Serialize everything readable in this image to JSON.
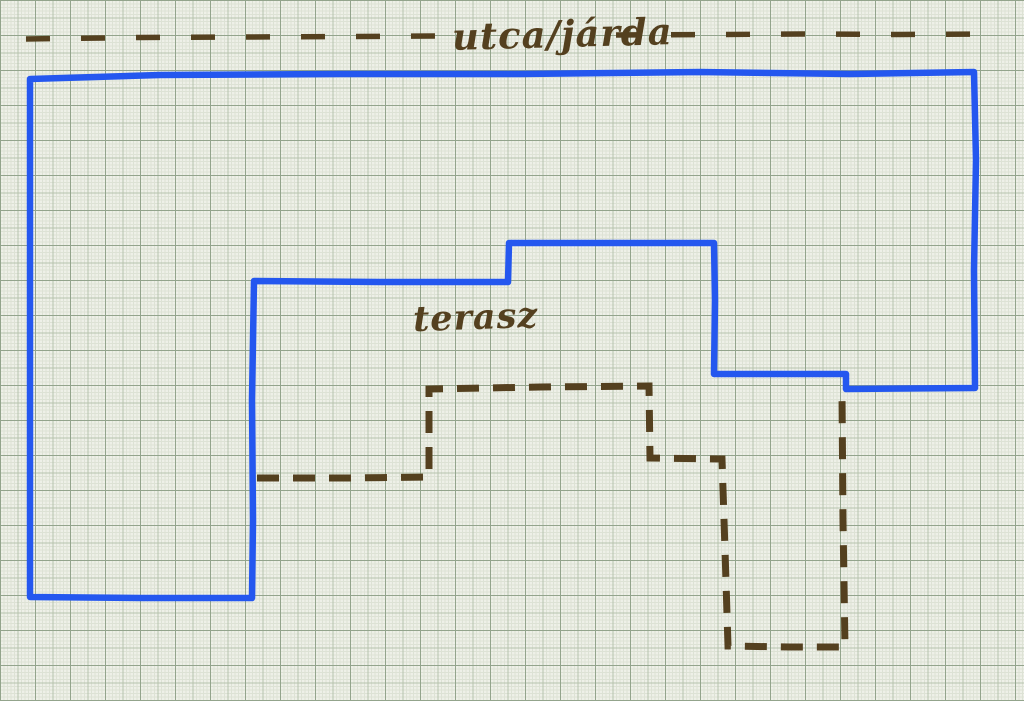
{
  "labels": {
    "street": "utca/járda",
    "terrace": "terasz"
  },
  "drawing": {
    "street_line_style": "dashed",
    "plot_boundary_style": "solid",
    "terrace_boundary_style": "dashed"
  },
  "colors": {
    "paper": "#eef0e8",
    "grid-fine": "#dde2d5",
    "grid-medium": "#b7c3ae",
    "grid-strong": "#93a48c",
    "ink-blue": "#2457ef",
    "ink-brown": "#54401f"
  }
}
